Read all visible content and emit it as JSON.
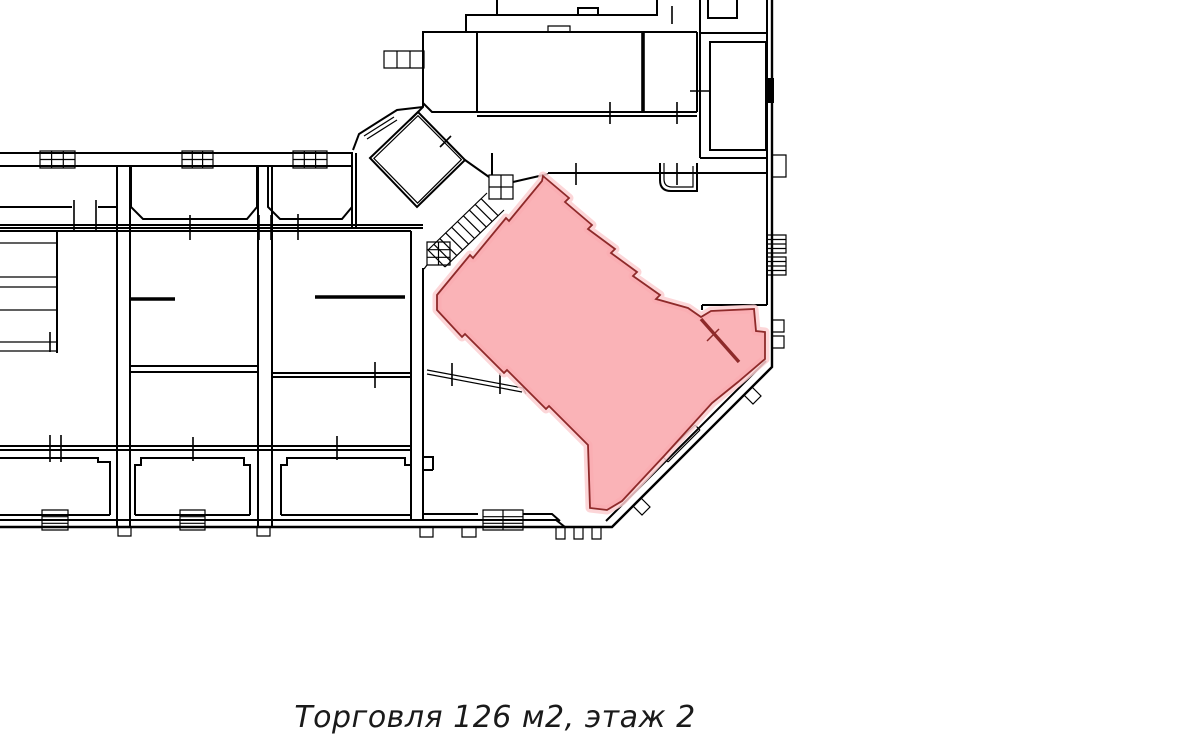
{
  "caption": {
    "text": "Торговля 126 м2, этаж 2"
  },
  "unit": {
    "type": "Торговля",
    "area_m2": 126,
    "floor": 2
  },
  "colors": {
    "highlight_fill": "#f9a9ad",
    "highlight_halo": "#fccfd1",
    "highlight_outline": "#8e2a2a",
    "wall_color": "#000000",
    "bg_color": "#ffffff",
    "caption_color": "#1a1a1a"
  }
}
